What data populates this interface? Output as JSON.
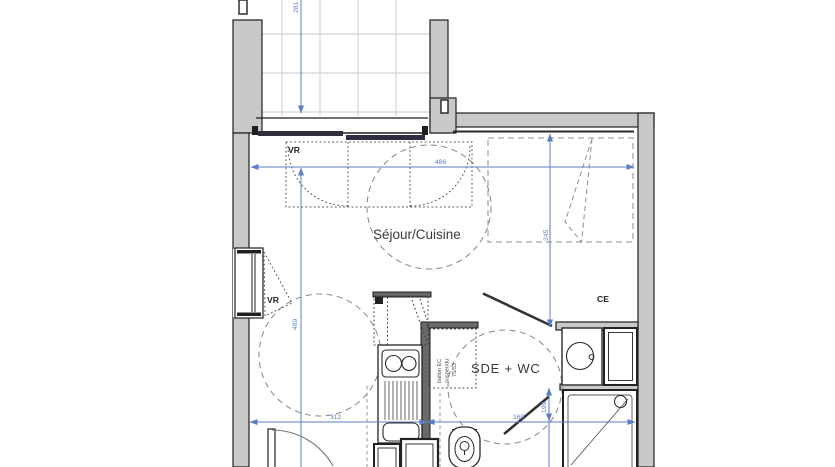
{
  "plan": {
    "rooms": {
      "sejour_cuisine": "Séjour/Cuisine",
      "sde_wc": "SDE + WC"
    },
    "labels": {
      "ce": "CE",
      "vr_top": "VR",
      "vr_left": "VR"
    },
    "water_heater_note": {
      "line1": "ballon EC",
      "line2": "suspendu",
      "line3": "75/53"
    },
    "dimensions": {
      "top_width": "486",
      "terrace_depth": "281",
      "right_depth": "245",
      "left_depth": "489",
      "bottom_left_width": "312",
      "bottom_right_width": "169",
      "shower_depth": "199"
    },
    "colors": {
      "wall_fill": "#c9c9c9",
      "wall_line": "#1f1f1f",
      "dimension_blue": "#5b7dc4",
      "dashed_gray": "#8f8f8f",
      "glazing_dark": "#2e2e3e",
      "tile_grid": "#d4d4d4"
    }
  }
}
